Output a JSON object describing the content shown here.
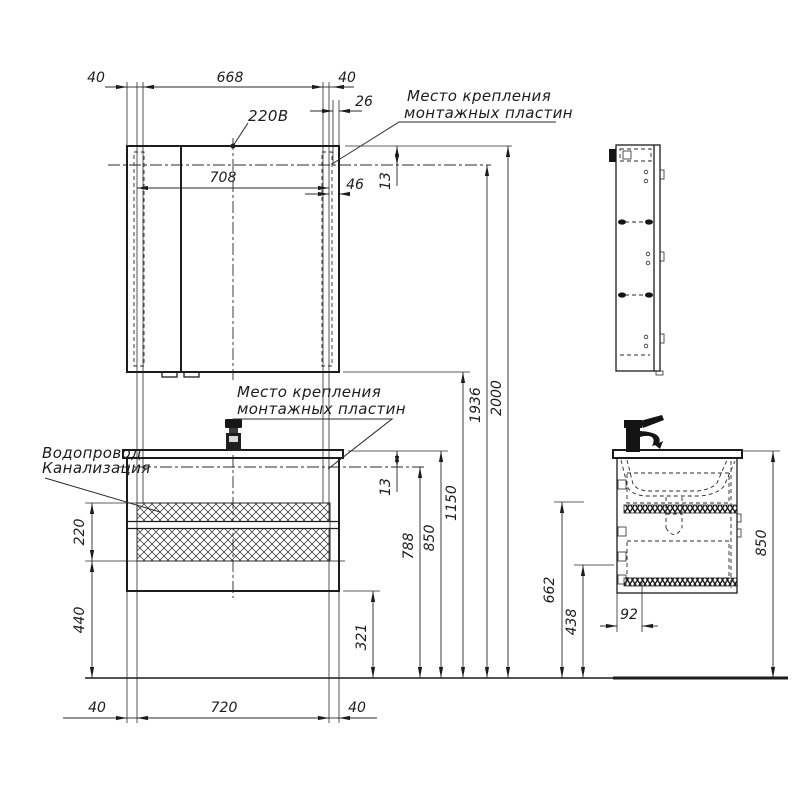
{
  "labels": {
    "power": "220В",
    "mounting_line1": "Место крепления",
    "mounting_line2": "монтажных пластин",
    "water": "Водопровод",
    "sewer": "Канализация"
  },
  "dims": {
    "n40": "40",
    "n668": "668",
    "n26": "26",
    "n708": "708",
    "n46": "46",
    "n13": "13",
    "n220": "220",
    "n440": "440",
    "n720": "720",
    "n321": "321",
    "n788": "788",
    "n850": "850",
    "n1150": "1150",
    "n1936": "1936",
    "n2000": "2000",
    "n662": "662",
    "n438": "438",
    "n92": "92"
  },
  "colors": {
    "line": "#1c1c1c",
    "background": "#ffffff"
  }
}
